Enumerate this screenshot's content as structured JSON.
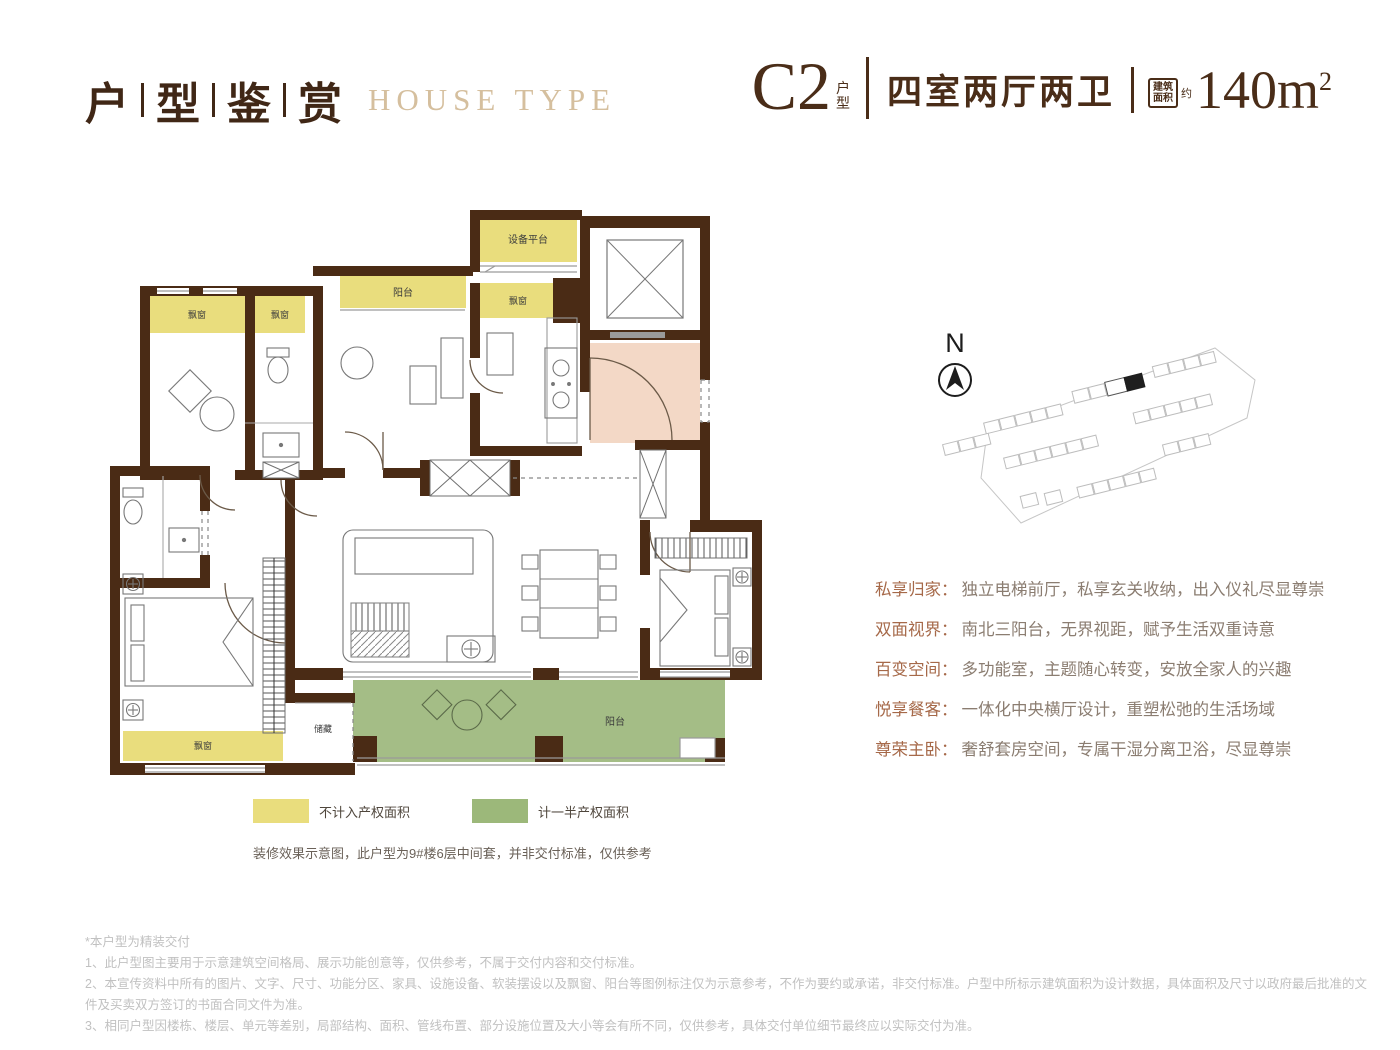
{
  "page": {
    "title_cn": [
      "户",
      "型",
      "鉴",
      "赏"
    ],
    "title_en": "HOUSE TYPE"
  },
  "unit": {
    "code": "C2",
    "code_label": "户型",
    "layout": "四室两厅两卫",
    "area_box_line1": "建筑",
    "area_box_line2": "面积",
    "area_approx": "约",
    "area_value": "140m",
    "area_exp": "2"
  },
  "plan": {
    "labels": {
      "equipment_platform": "设备平台",
      "balcony_north": "阳台",
      "bay_window_a": "飘窗",
      "bay_window_b": "飘窗",
      "bay_window_kitchen": "飘窗",
      "bay_window_master": "飘窗",
      "storage": "储藏",
      "balcony_south": "阳台"
    },
    "colors": {
      "wall": "#4a2b15",
      "no_property_area": "#e9dd7d",
      "half_property_area": "#a4bd86",
      "elevator_hall": "#f3d8c6"
    }
  },
  "compass": {
    "north": "N"
  },
  "features": [
    {
      "title": "私享归家：",
      "desc": "独立电梯前厅，私享玄关收纳，出入仪礼尽显尊崇"
    },
    {
      "title": "双面视界：",
      "desc": "南北三阳台，无界视距，赋予生活双重诗意"
    },
    {
      "title": "百变空间：",
      "desc": "多功能室，主题随心转变，安放全家人的兴趣"
    },
    {
      "title": "悦享餐客：",
      "desc": "一体化中央横厅设计，重塑松弛的生活场域"
    },
    {
      "title": "尊荣主卧：",
      "desc": "奢舒套房空间，专属干湿分离卫浴，尽显尊崇"
    }
  ],
  "legend": {
    "items": [
      {
        "label": "不计入产权面积",
        "color": "#e9dd7d"
      },
      {
        "label": "计一半产权面积",
        "color": "#9cb87a"
      }
    ],
    "note": "装修效果示意图，此户型为9#楼6层中间套，并非交付标准，仅供参考"
  },
  "disclaimer": {
    "lines": [
      "*本户型为精装交付",
      "1、此户型图主要用于示意建筑空间格局、展示功能创意等，仅供参考，不属于交付内容和交付标准。",
      "2、本宣传资料中所有的图片、文字、尺寸、功能分区、家具、设施设备、软装摆设以及飘窗、阳台等图例标注仅为示意参考，不作为要约或承诺，非交付标准。户型中所标示建筑面积为设计数据，具体面积及尺寸以政府最后批准的文件及买卖双方签订的书面合同文件为准。",
      "3、相同户型因楼栋、楼层、单元等差别，局部结构、面积、管线布置、部分设施位置及大小等会有所不同，仅供参考，具体交付单位细节最终应以实际交付为准。"
    ]
  }
}
